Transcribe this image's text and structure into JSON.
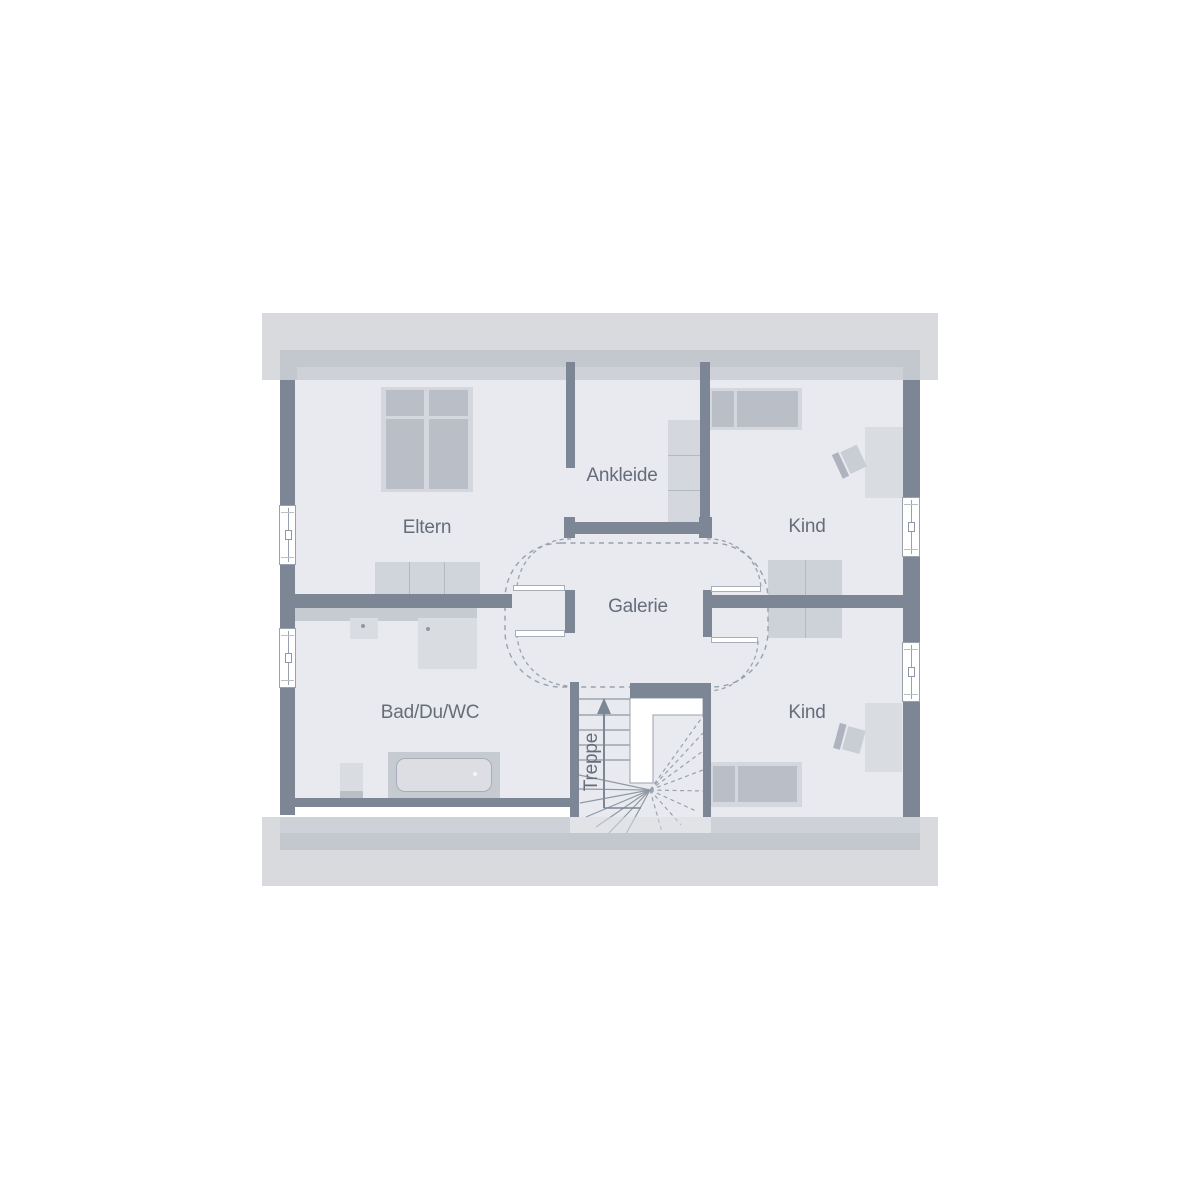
{
  "plan": {
    "rooms": [
      {
        "id": "eltern",
        "label": "Eltern"
      },
      {
        "id": "ankleide",
        "label": "Ankleide"
      },
      {
        "id": "kind-oben",
        "label": "Kind"
      },
      {
        "id": "galerie",
        "label": "Galerie"
      },
      {
        "id": "bad-du-wc",
        "label": "Bad/Du/WC"
      },
      {
        "id": "kind-unten",
        "label": "Kind"
      },
      {
        "id": "treppe",
        "label": "Treppe"
      }
    ],
    "colors": {
      "wall": "#7d8694",
      "floor": "#e8eaef",
      "roof_overhang_light": "#d8dade",
      "roof_overhang_medium": "#c3c7ce",
      "roof_overhang_inner": "#ced2d8",
      "furniture_light": "#d4d7dd",
      "furniture_dark": "#b9bec7",
      "line": "#99a1ad",
      "label_text": "#666d7a"
    }
  }
}
